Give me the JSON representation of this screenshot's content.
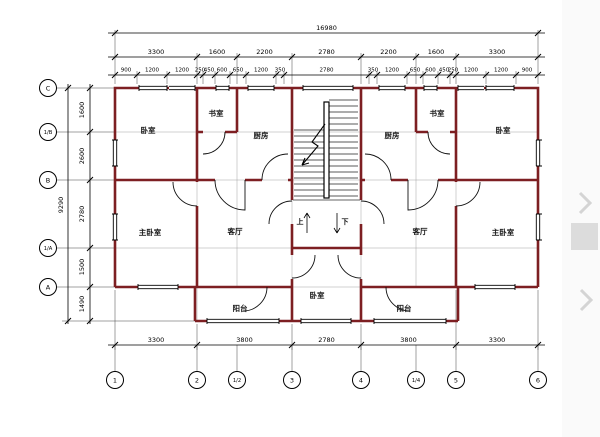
{
  "drawing": {
    "type": "floor-plan",
    "dims": {
      "top_overall": "16980",
      "top_main": [
        "3300",
        "1600",
        "2200",
        "2780",
        "2200",
        "1600",
        "3300"
      ],
      "top_detail": [
        "900",
        "1200",
        "1200",
        "250",
        "450",
        "600",
        "650",
        "1200",
        "350",
        "2780",
        "350",
        "1200",
        "650",
        "600",
        "450",
        "250",
        "1200",
        "1200",
        "900"
      ],
      "bottom": [
        "3300",
        "3800",
        "2780",
        "3800",
        "3300"
      ],
      "left_overall": "9290",
      "left": [
        "1600",
        "2600",
        "2780",
        "1500",
        "1490"
      ]
    },
    "axes": {
      "left": [
        "C",
        "1/B",
        "B",
        "1/A",
        "A"
      ],
      "bottom": [
        "1",
        "2",
        "1/2",
        "3",
        "4",
        "1/4",
        "5",
        "6"
      ]
    },
    "rooms": {
      "bedroom_left": "卧室",
      "study_left": "书室",
      "kitchen_left": "厨房",
      "kitchen_right": "厨房",
      "study_right": "书室",
      "bedroom_right": "卧室",
      "master_left": "主卧室",
      "living_left": "客厅",
      "living_right": "客厅",
      "master_right": "主卧室",
      "balcony_left": "阳台",
      "bedroom_center": "卧室",
      "balcony_right": "阳台"
    },
    "stairs": {
      "up": "上",
      "down": "下"
    },
    "colors": {
      "wall": "#7d1f22",
      "lines": "#000000",
      "ui_gray": "#d8d8d8"
    }
  }
}
